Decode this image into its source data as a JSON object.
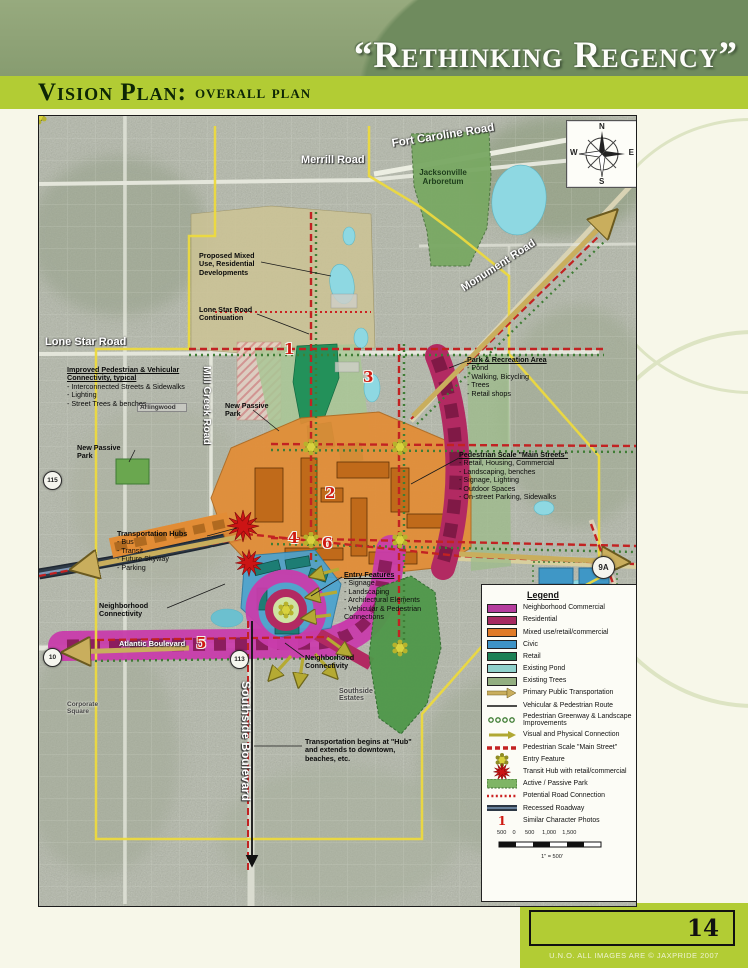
{
  "header": {
    "title": "“Rethinking Regency”",
    "section_title": "Vision Plan:",
    "section_subtitle": "overall plan"
  },
  "footer": {
    "page_number": "14",
    "copyright": "U.N.O. ALL IMAGES ARE © JAXPRIDE 2007"
  },
  "colors": {
    "accent_lime": "#b2cc34",
    "banner_sage": "#879c70",
    "neighborhood_commercial": "#c83cab",
    "residential": "#b22a62",
    "mixed_use": "#e28c35",
    "civic": "#3f97c6",
    "retail": "#23915a",
    "existing_pond": "#8ed8e2",
    "existing_trees": "#9cbb8a",
    "transit_tan": "#c9ae5d",
    "main_street_red": "#c22222",
    "park_green": "#6aa74f"
  },
  "map": {
    "compass": {
      "n": "N",
      "e": "E",
      "s": "S",
      "w": "W"
    },
    "road_labels": [
      {
        "text": "Merrill Road",
        "x": 262,
        "y": 38,
        "size": 11,
        "rot": 0
      },
      {
        "text": "Fort Caroline Road",
        "x": 352,
        "y": 22,
        "size": 11.5,
        "rot": -9
      },
      {
        "text": "Monument Road",
        "x": 420,
        "y": 168,
        "size": 11,
        "rot": -33
      },
      {
        "text": "Lone Star Road",
        "x": 6,
        "y": 220,
        "size": 11,
        "rot": 0
      },
      {
        "text": "Mill Creek Road",
        "x": 162,
        "y": 250,
        "size": 10.5,
        "rot": 0,
        "vertical": true
      },
      {
        "text": "Southside Boulevard",
        "x": 200,
        "y": 565,
        "size": 12,
        "rot": 0,
        "vertical": true
      },
      {
        "text": "Atlantic Boulevard",
        "x": 80,
        "y": 523,
        "size": 7.5,
        "rot": 0
      }
    ],
    "place_labels": [
      {
        "text": "Jacksonville Arboretum",
        "x": 368,
        "y": 52,
        "w": 72,
        "size": 8,
        "kind": "green"
      },
      {
        "text": "Arlingwood",
        "x": 98,
        "y": 287,
        "w": 44,
        "size": 6.5,
        "kind": "boxed"
      },
      {
        "text": "Southside Estates",
        "x": 300,
        "y": 572,
        "w": 52,
        "size": 7,
        "kind": "plain"
      },
      {
        "text": "Corporate Square",
        "x": 28,
        "y": 585,
        "w": 46,
        "size": 6.5,
        "kind": "plain"
      }
    ],
    "shields": [
      {
        "text": "115",
        "x": 4,
        "y": 355,
        "d": 17
      },
      {
        "text": "10",
        "x": 4,
        "y": 532,
        "d": 17
      },
      {
        "text": "113",
        "x": 191,
        "y": 534,
        "d": 17
      },
      {
        "text": "9A",
        "x": 553,
        "y": 440,
        "d": 21
      }
    ],
    "markers": [
      {
        "n": "1",
        "x": 245,
        "y": 224
      },
      {
        "n": "2",
        "x": 286,
        "y": 368
      },
      {
        "n": "3",
        "x": 324,
        "y": 252
      },
      {
        "n": "4",
        "x": 249,
        "y": 413
      },
      {
        "n": "5",
        "x": 157,
        "y": 518
      },
      {
        "n": "6",
        "x": 283,
        "y": 418
      }
    ],
    "callouts": [
      {
        "id": "proposed-development",
        "x": 160,
        "y": 136,
        "w": 62,
        "u": false,
        "title": "Proposed Mixed Use, Residential Developments",
        "items": []
      },
      {
        "id": "lone-star-continuation",
        "x": 160,
        "y": 190,
        "w": 70,
        "u": false,
        "title": "Lone Star Road Continuation",
        "items": []
      },
      {
        "id": "improved-connectivity",
        "x": 28,
        "y": 250,
        "w": 136,
        "u": true,
        "title": "Improved Pedestrian & Vehicular Connectivity, typical",
        "items": [
          "- Interconnected Streets & Sidewalks",
          "- Lighting",
          "- Street Trees & benches"
        ]
      },
      {
        "id": "new-passive-park-west",
        "x": 38,
        "y": 328,
        "w": 56,
        "u": false,
        "title": "New Passive Park",
        "items": []
      },
      {
        "id": "new-passive-park-center",
        "x": 186,
        "y": 286,
        "w": 56,
        "u": false,
        "title": "New Passive Park",
        "items": []
      },
      {
        "id": "park-recreation-area",
        "x": 428,
        "y": 240,
        "w": 112,
        "u": true,
        "title": "Park & Recreation Area",
        "items": [
          "- Pond",
          "- Walking, Bicycling",
          "- Trees",
          "- Retail shops"
        ]
      },
      {
        "id": "pedestrian-main-streets",
        "x": 420,
        "y": 335,
        "w": 132,
        "u": true,
        "title": "Pedestrian Scale \"Main Streets\"",
        "items": [
          "- Retail, Housing, Commercial",
          "- Landscaping, benches",
          "- Signage, Lighting",
          "- Outdoor Spaces",
          "- On-street Parking, Sidewalks"
        ]
      },
      {
        "id": "transportation-hubs",
        "x": 78,
        "y": 414,
        "w": 96,
        "u": false,
        "title": "Transportation Hubs",
        "items": [
          "- Bus",
          "- Transit",
          "- Future Skyway",
          "- Parking"
        ]
      },
      {
        "id": "neighborhood-connectivity-west",
        "x": 60,
        "y": 486,
        "w": 66,
        "u": false,
        "title": "Neighborhood Connectivity",
        "items": []
      },
      {
        "id": "entry-features",
        "x": 305,
        "y": 455,
        "w": 108,
        "u": true,
        "title": "Entry Features",
        "items": [
          "- Signage",
          "- Landscaping",
          "- Architectural Elements",
          "- Vehicular & Pedestrian",
          "  Connections"
        ]
      },
      {
        "id": "neighborhood-connectivity-south",
        "x": 266,
        "y": 538,
        "w": 66,
        "u": false,
        "title": "Neighborhood Connectivity",
        "items": []
      },
      {
        "id": "transportation-begins",
        "x": 266,
        "y": 622,
        "w": 120,
        "u": false,
        "title": "Transportation begins at \"Hub\" and extends to downtown, beaches, etc.",
        "items": []
      }
    ]
  },
  "legend": {
    "title": "Legend",
    "items": [
      {
        "label": "Neighborhood Commercial",
        "type": "solid",
        "color": "#b53d9e"
      },
      {
        "label": "Residential",
        "type": "solid",
        "color": "#a62960"
      },
      {
        "label": "Mixed use/retail/commercial",
        "type": "solid",
        "color": "#e07b28"
      },
      {
        "label": "Civic",
        "type": "solid",
        "color": "#3e93c6"
      },
      {
        "label": "Retail",
        "type": "solid",
        "color": "#1b8055"
      },
      {
        "label": "Existing Pond",
        "type": "solid",
        "color": "#8fd2cc"
      },
      {
        "label": "Existing Trees",
        "type": "solid",
        "color": "#93af80"
      },
      {
        "label": "Primary Public Transportation",
        "type": "tan-arrow",
        "color": "#c9ae5d"
      },
      {
        "label": "Vehicular & Pedestrian Route",
        "type": "black-line",
        "color": "#111111"
      },
      {
        "label": "Pedestrian Greenway & Landscape Improvements",
        "type": "green-dots",
        "color": "#3f7d35"
      },
      {
        "label": "Visual and Physical Connection",
        "type": "yellow-arrow",
        "color": "#b0a832"
      },
      {
        "label": "Pedestrian Scale \"Main Street\"",
        "type": "red-dash",
        "color": "#c32222"
      },
      {
        "label": "Entry Feature",
        "type": "flower",
        "color": "#d8d23e"
      },
      {
        "label": "Transit Hub with retail/commercial",
        "type": "star",
        "color": "#cc1414"
      },
      {
        "label": "Active / Passive Park",
        "type": "park",
        "color": "#7fb565"
      },
      {
        "label": "Potential Road Connection",
        "type": "red-dots",
        "color": "#cc2222"
      },
      {
        "label": "Recessed Roadway",
        "type": "recessed",
        "color": "#2c3744"
      },
      {
        "label": "Similar Character Photos",
        "type": "numeral",
        "color": "#cf1a12",
        "glyph": "1"
      }
    ],
    "scale": {
      "ticks": "500    0      500     1,000    1,500",
      "note": "1\" = 500'"
    }
  }
}
